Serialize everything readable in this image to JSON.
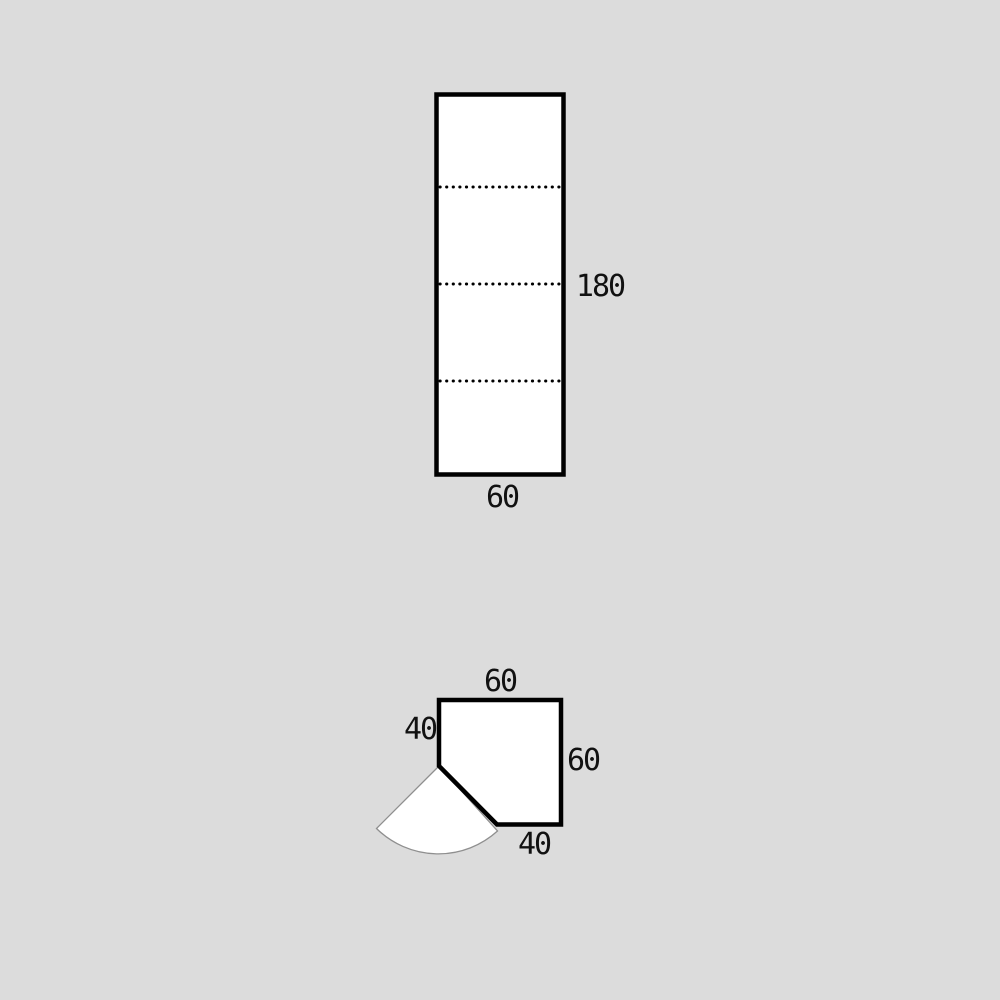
{
  "colors": {
    "background": "#dcdcdc",
    "shape_fill": "#ffffff",
    "outline": "#000000",
    "door_arc": "#8f8f8f",
    "text": "#111111"
  },
  "tall_cabinet": {
    "height_label": "180",
    "width_label": "60",
    "dotted_divider_count": 3
  },
  "corner_cabinet": {
    "top_edge_label": "60",
    "left_edge_label": "40",
    "right_edge_label": "60",
    "bottom_edge_label": "40"
  }
}
